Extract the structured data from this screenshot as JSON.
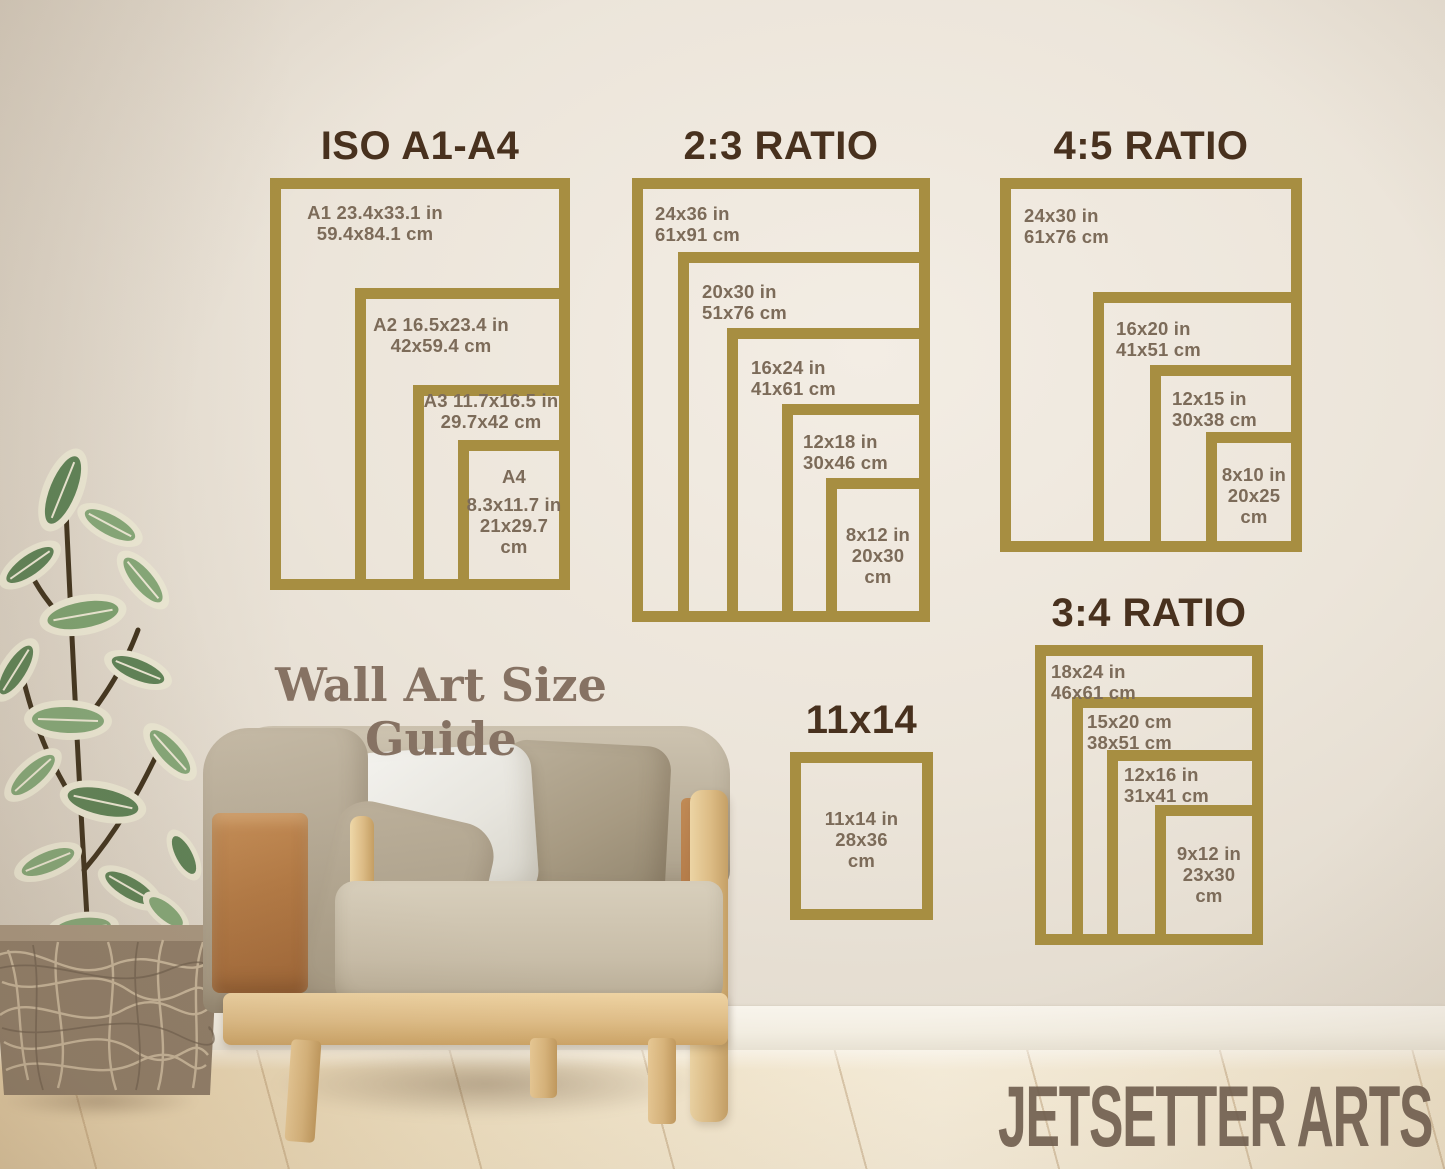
{
  "guide_title": "Wall Art Size Guide",
  "watermark": "JETSETTER ARTS",
  "colors": {
    "frame_gold": "#a78e41",
    "heading_brown": "#48311e",
    "label_brown": "#7c6b59",
    "wall_cream": "#ece5da",
    "floor_wood": "#f0e1c2"
  },
  "groups": [
    {
      "title": "ISO A1-A4",
      "frames": [
        {
          "lines": [
            "A1 23.4x33.1 in",
            "59.4x84.1 cm"
          ]
        },
        {
          "lines": [
            "A2 16.5x23.4 in",
            "42x59.4 cm"
          ]
        },
        {
          "lines": [
            "A3 11.7x16.5 in",
            "29.7x42 cm"
          ]
        },
        {
          "name": "A4",
          "lines": [
            "8.3x11.7 in",
            "21x29.7",
            "cm"
          ]
        }
      ]
    },
    {
      "title": "2:3 RATIO",
      "frames": [
        {
          "lines": [
            "24x36 in",
            "61x91 cm"
          ]
        },
        {
          "lines": [
            "20x30 in",
            "51x76 cm"
          ]
        },
        {
          "lines": [
            "16x24 in",
            "41x61 cm"
          ]
        },
        {
          "lines": [
            "12x18 in",
            "30x46 cm"
          ]
        },
        {
          "lines": [
            "8x12 in",
            "20x30",
            "cm"
          ]
        }
      ]
    },
    {
      "title": "4:5 RATIO",
      "frames": [
        {
          "lines": [
            "24x30 in",
            "61x76 cm"
          ]
        },
        {
          "lines": [
            "16x20 in",
            "41x51 cm"
          ]
        },
        {
          "lines": [
            "12x15 in",
            "30x38 cm"
          ]
        },
        {
          "lines": [
            "8x10 in",
            "20x25",
            "cm"
          ]
        }
      ]
    },
    {
      "title": "3:4 RATIO",
      "frames": [
        {
          "lines": [
            "18x24 in",
            "46x61 cm"
          ]
        },
        {
          "lines": [
            "15x20 cm",
            "38x51 cm"
          ]
        },
        {
          "lines": [
            "12x16 in",
            "31x41 cm"
          ]
        },
        {
          "lines": [
            "9x12 in",
            "23x30",
            "cm"
          ]
        }
      ]
    },
    {
      "title": "11x14",
      "frames": [
        {
          "lines": [
            "11x14 in",
            "28x36",
            "cm"
          ]
        }
      ]
    }
  ]
}
